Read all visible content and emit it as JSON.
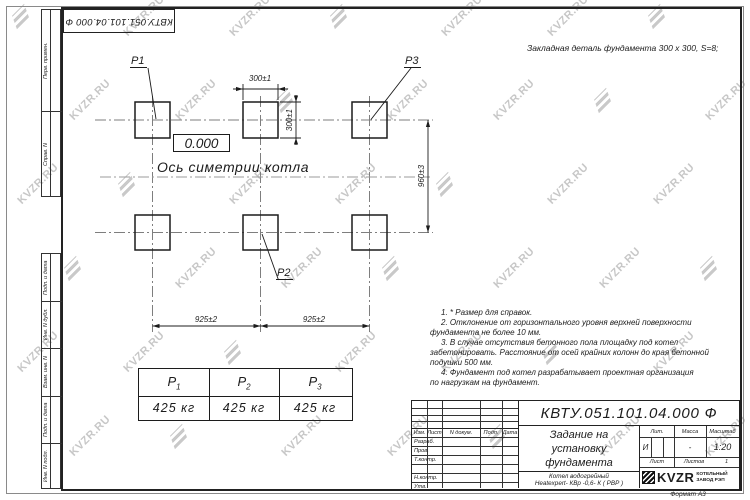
{
  "watermark": {
    "text": "KVZR.RU"
  },
  "stamp_top_left": "КВТУ.051.101.04.000  Ф",
  "side_columns": {
    "top": [
      "Перв. примен.",
      "Справ. N"
    ],
    "bottom": [
      "Подп. и дата",
      "Инв. N дубл.",
      "Взам. инв. N",
      "Подп. и дата",
      "Инв. N подл."
    ]
  },
  "drawing": {
    "embed_note": "Закладная деталь фундамента  300 х 300,  S=8;",
    "elevation": "0.000",
    "axis_label": "Ось симетрии котла",
    "p1": "P1",
    "p2": "P2",
    "p3": "P3",
    "dims": {
      "top_width": "300±1",
      "side_height": "300±1",
      "vertical": "960±3",
      "left_span": "925±2",
      "right_span": "925±2"
    }
  },
  "notes": {
    "lines": [
      "1.  * Размер для справок.",
      "2.  Отклонение от горизонтального уровня верхней поверхности",
      "фундамента не более 10 мм.",
      "3.  В случае отсутствия бетонного пола площадку под котел",
      "забетонировать. Расстояние от осей крайних колонн до края бетонной",
      "подушки 500 мм.",
      "4.  Фундамент под котел разрабатывает проектная организация",
      "по нагрузкам на фундамент."
    ]
  },
  "loads_table": {
    "cols": [
      {
        "sym": "Р",
        "sub": "1",
        "value": "425 кг"
      },
      {
        "sym": "Р",
        "sub": "2",
        "value": "425 кг"
      },
      {
        "sym": "Р",
        "sub": "3",
        "value": "425 кг"
      }
    ]
  },
  "title_block": {
    "doc_number": "КВТУ.051.101.04.000  Ф",
    "title_lines": [
      "Задание на",
      "установку",
      "фундамента"
    ],
    "product_lines": [
      "Котел водогрейный",
      "Heatexpert- КВр -0,6- К ( РВР )"
    ],
    "header": {
      "izm": "Изм.",
      "list": "Лист",
      "doc": "N докум.",
      "sign": "Подп.",
      "date": "Дата"
    },
    "rows": [
      "Разраб.",
      "Пров.",
      "Т.контр.",
      "",
      "Н.контр.",
      "Утв."
    ],
    "lit_label": "Лит.",
    "mass_label": "Масса",
    "scale_label": "Масштаб",
    "lit_value": "И",
    "mass_value": "-",
    "scale_value": "1:20",
    "sheet_label": "Лист",
    "sheets_label": "Листов",
    "sheets_value": "1",
    "brand": "KVZR",
    "brand_sub1": "КОТЕЛЬНЫЙ",
    "brand_sub2": "ЗАВОД РЭП",
    "format": "Формат А3"
  }
}
